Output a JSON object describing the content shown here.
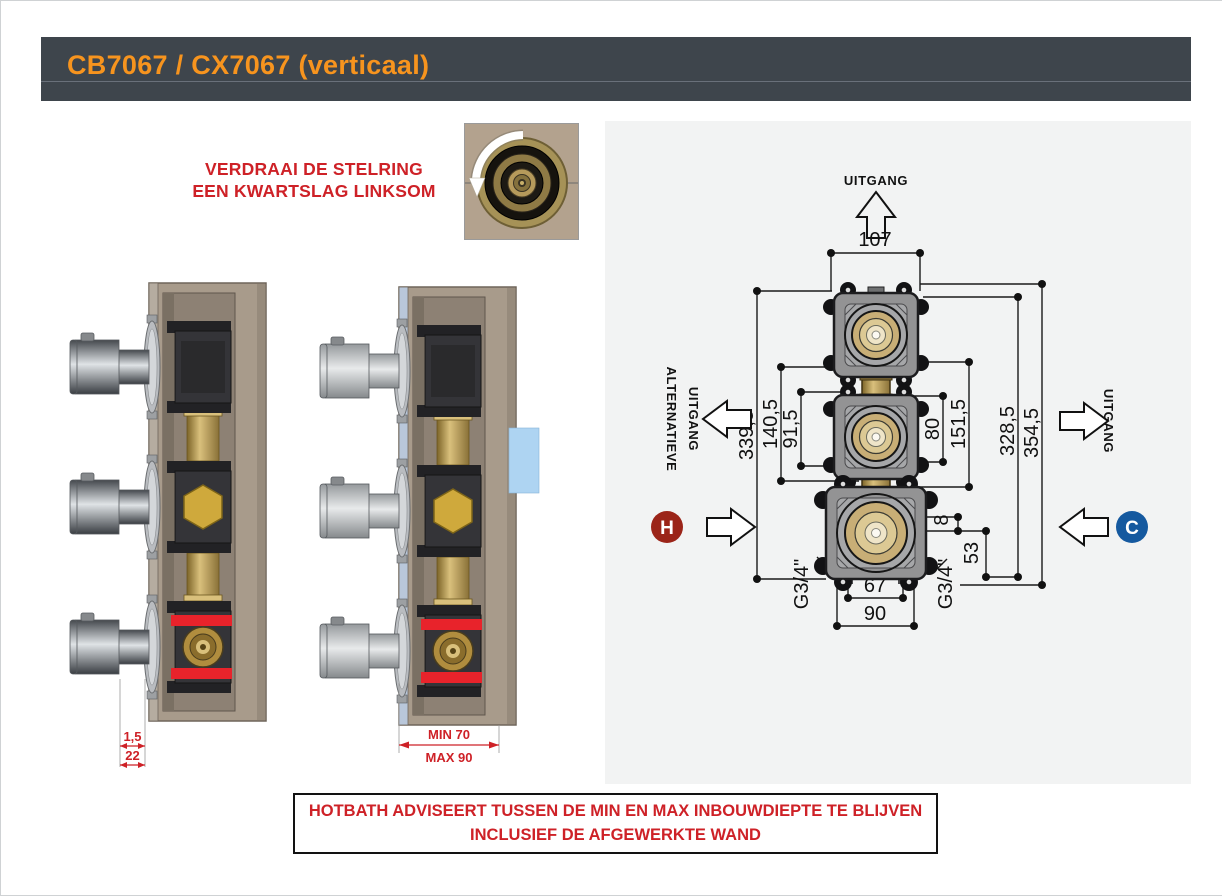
{
  "page": {
    "title": "CB7067 / CX7067 (verticaal)"
  },
  "instruction": {
    "line1": "VERDRAAI DE STELRING",
    "line2": "EEN KWARTSLAG LINKSOM"
  },
  "diagram": {
    "outlet_top_label": "UITGANG",
    "outlet_left_line1": "ALTERNATIEVE",
    "outlet_left_line2": "UITGANG",
    "outlet_right_label": "UITGANG",
    "hot_label": "H",
    "cold_label": "C",
    "dims": {
      "top_width": "107",
      "left_outer": "339,5",
      "left_mid": "140,5",
      "left_inner": "91,5",
      "right_inner": "80",
      "right_mid": "151,5",
      "right_outer": "328,5",
      "right_total": "354,5",
      "offset_small": "8",
      "bottom_offset": "53",
      "ports_width": "67",
      "body_width": "90",
      "thread_left": "G3/4\"",
      "thread_right": "G3/4\""
    }
  },
  "renders": {
    "left": {
      "dim_top": "1,5",
      "dim_bottom": "22"
    },
    "right": {
      "dim_min": "MIN 70",
      "dim_max": "MAX 90"
    }
  },
  "notice": {
    "line1": "HOTBATH ADVISEERT TUSSEN DE MIN EN MAX INBOUWDIEPTE TE BLIJVEN",
    "line2": "INCLUSIEF DE AFGEWERKTE WAND"
  },
  "colors": {
    "accent_orange": "#F7941E",
    "header_bg": "#3E454C",
    "alert_red": "#CE2127",
    "hot_red": "#9B2418",
    "cold_blue": "#15599F",
    "panel_gray": "#F2F3F3",
    "wall_tan": "#A89B8B"
  }
}
